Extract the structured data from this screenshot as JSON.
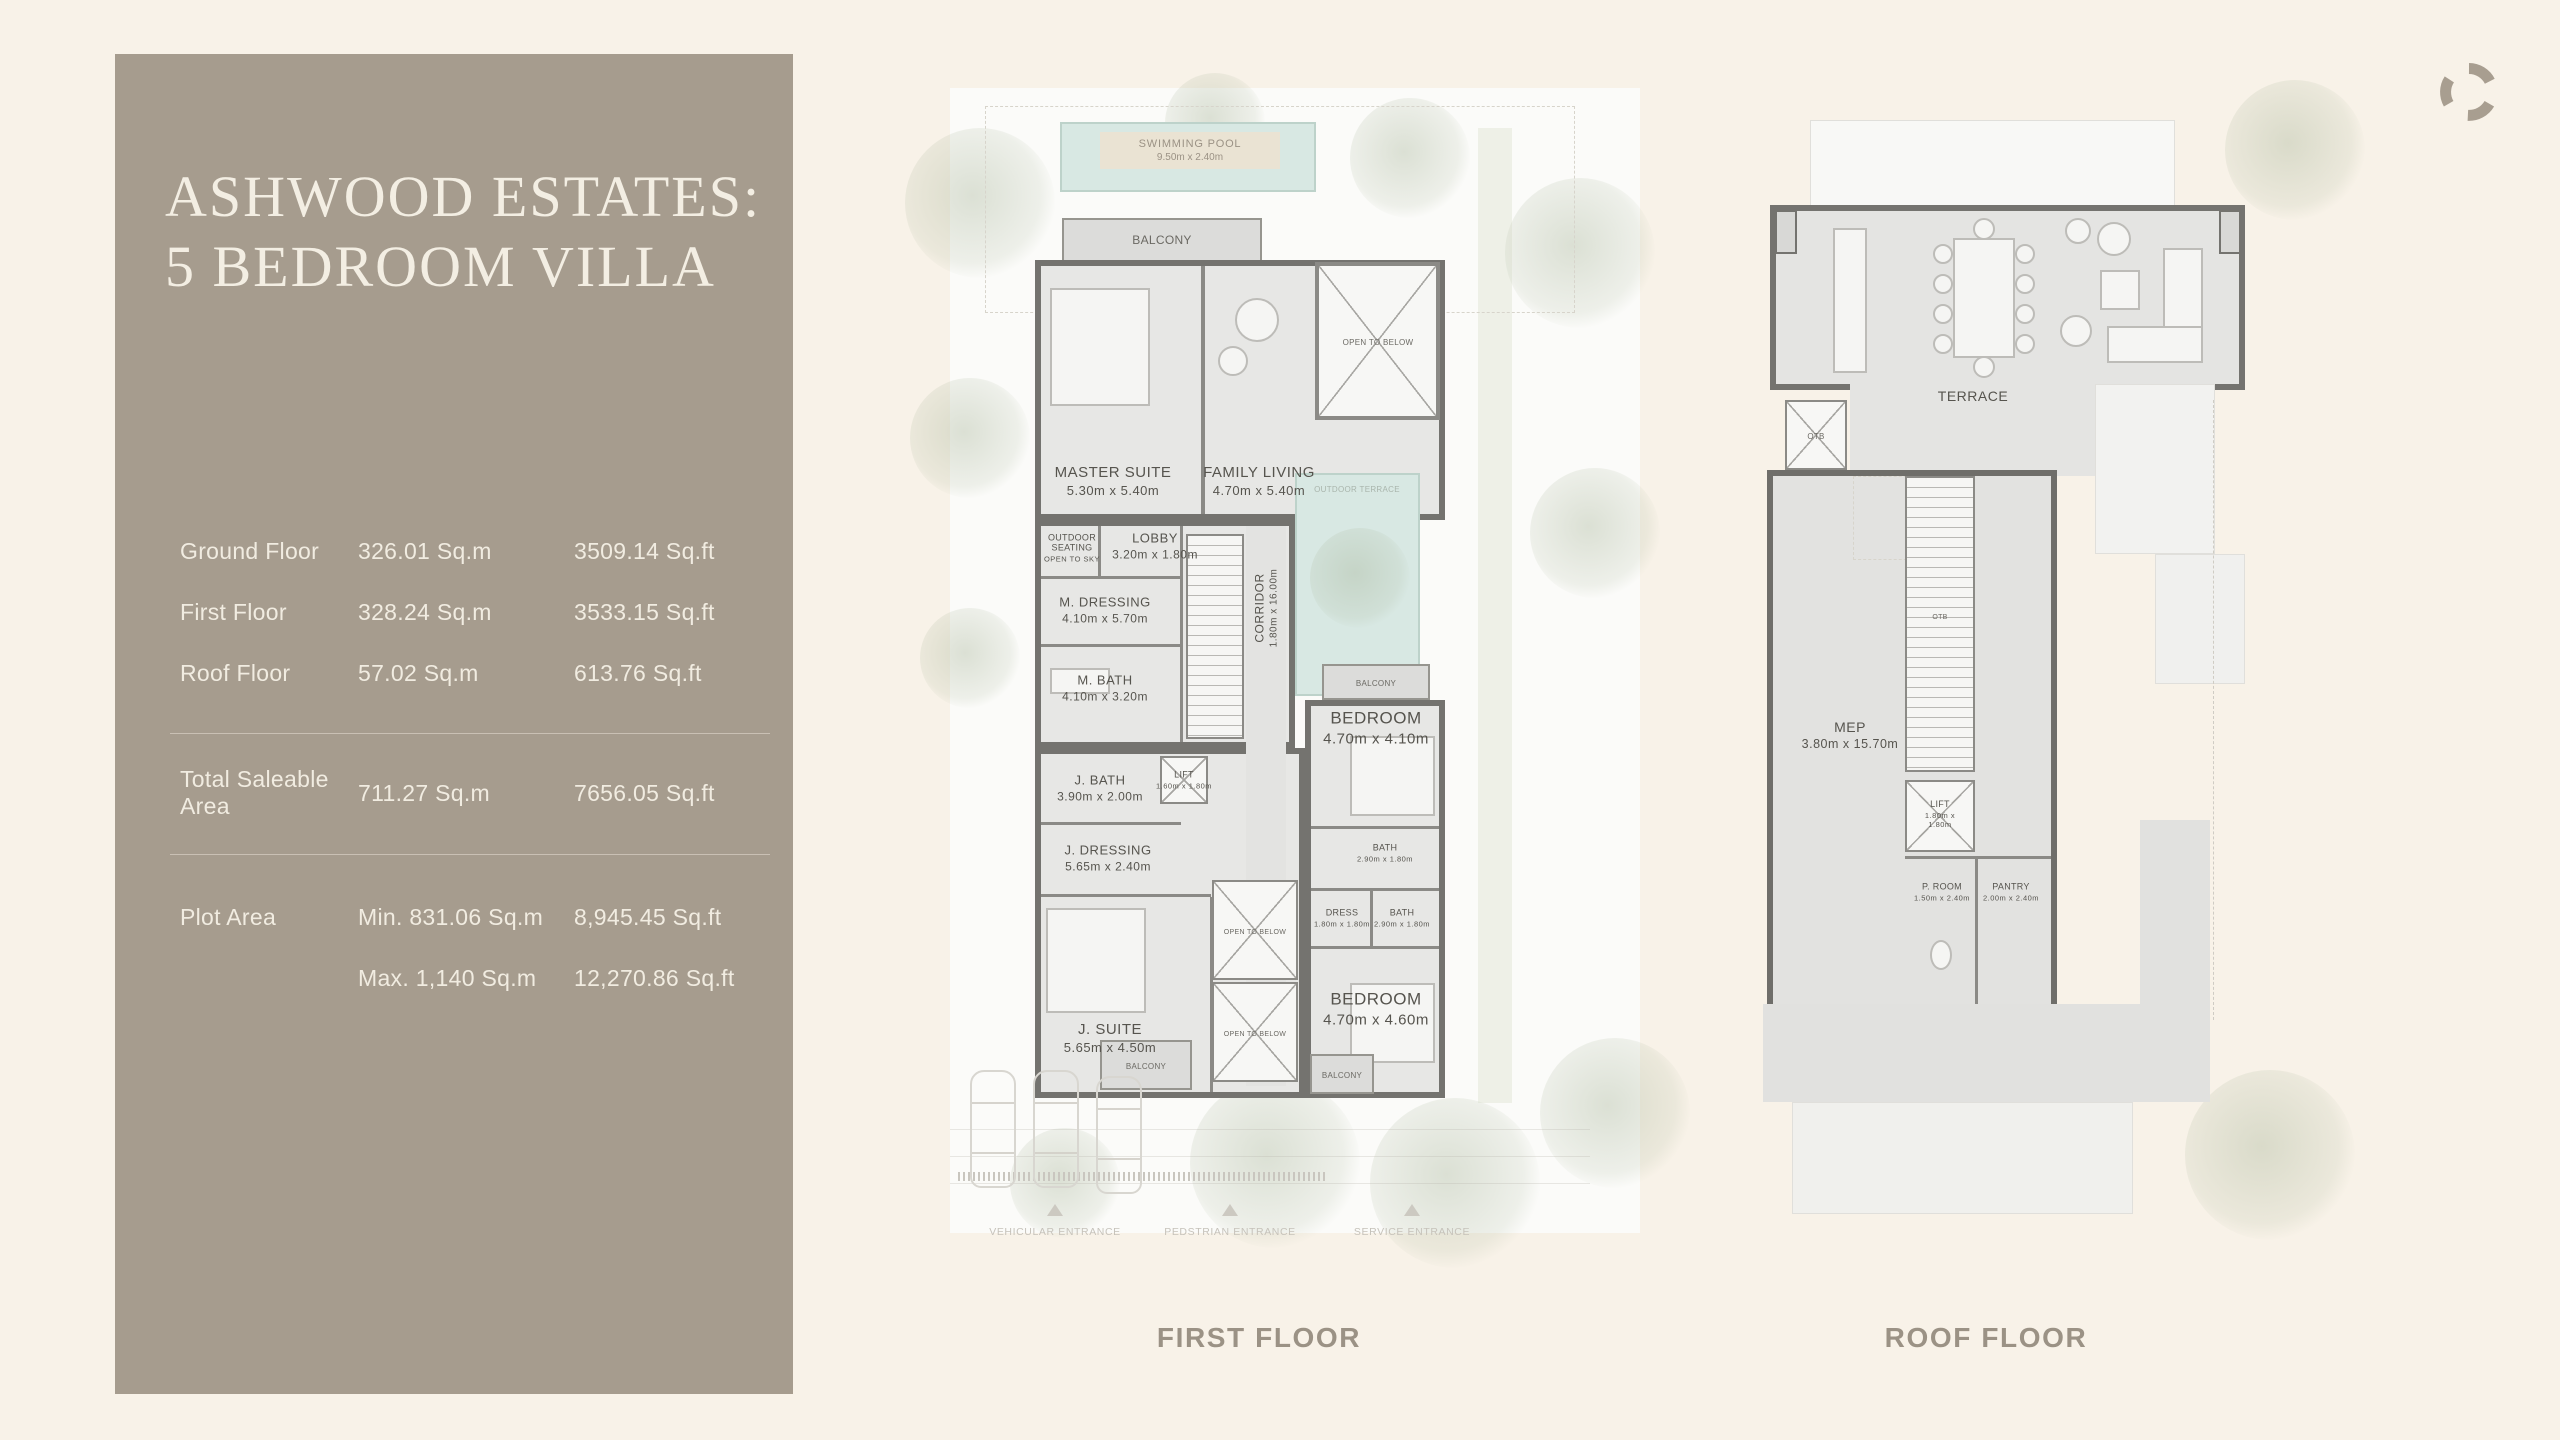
{
  "colors": {
    "page_background": "#f8f2e8",
    "sidebar_background": "#a69c8e",
    "sidebar_text": "#f1ece1",
    "plan_wall": "#74736f",
    "plan_room_fill": "#e7e7e5",
    "pool_fill": "#d8e8e3",
    "caption_text": "#9b9285"
  },
  "brand": {
    "logo_icon": "swirl-logo"
  },
  "sidebar": {
    "title_line1": "ASHWOOD ESTATES:",
    "title_line2": "5 BEDROOM VILLA",
    "floors": [
      {
        "label": "Ground Floor",
        "sqm": "326.01 Sq.m",
        "sqft": "3509.14 Sq.ft"
      },
      {
        "label": "First Floor",
        "sqm": "328.24 Sq.m",
        "sqft": "3533.15 Sq.ft"
      },
      {
        "label": "Roof Floor",
        "sqm": "57.02 Sq.m",
        "sqft": "613.76 Sq.ft"
      }
    ],
    "total": {
      "label": "Total Saleable Area",
      "sqm": "711.27 Sq.m",
      "sqft": "7656.05 Sq.ft"
    },
    "plot": {
      "label": "Plot Area",
      "min_sqm": "Min. 831.06 Sq.m",
      "min_sqft": "8,945.45 Sq.ft",
      "max_sqm": "Max. 1,140 Sq.m",
      "max_sqft": "12,270.86 Sq.ft"
    }
  },
  "plans": {
    "first": {
      "caption": "FIRST FLOOR",
      "rooms": {
        "pool": {
          "name": "SWIMMING POOL",
          "dims": "9.50m x 2.40m"
        },
        "balcony": {
          "name": "BALCONY"
        },
        "master_suite": {
          "name": "MASTER SUITE",
          "dims": "5.30m x 5.40m"
        },
        "family_living": {
          "name": "FAMILY LIVING",
          "dims": "4.70m x 5.40m"
        },
        "open_to_below": {
          "name": "OPEN TO BELOW"
        },
        "outdoor_seating": {
          "name": "OUTDOOR SEATING",
          "note": "OPEN TO SKY"
        },
        "lobby": {
          "name": "LOBBY",
          "dims": "3.20m x 1.80m"
        },
        "m_dressing": {
          "name": "M. DRESSING",
          "dims": "4.10m x 5.70m"
        },
        "m_bath": {
          "name": "M. BATH",
          "dims": "4.10m x 3.20m"
        },
        "corridor": {
          "name": "CORRIDOR",
          "dims": "1.80m x 16.00m"
        },
        "outdoor_terrace": {
          "name": "OUTDOOR TERRACE"
        },
        "j_bath": {
          "name": "J. BATH",
          "dims": "3.90m x 2.00m"
        },
        "lift": {
          "name": "LIFT",
          "dims": "1.60m x 1.80m"
        },
        "j_dressing": {
          "name": "J. DRESSING",
          "dims": "5.65m x 2.40m"
        },
        "j_suite": {
          "name": "J. SUITE",
          "dims": "5.65m x 4.50m"
        },
        "bedroom_top": {
          "name": "BEDROOM",
          "dims": "4.70m x 4.10m"
        },
        "bath_top": {
          "name": "BATH",
          "dims": "2.90m x 1.80m"
        },
        "dress": {
          "name": "DRESS",
          "dims": "1.80m x 1.80m"
        },
        "bath_bottom": {
          "name": "BATH",
          "dims": "2.90m x 1.80m"
        },
        "bedroom_bottom": {
          "name": "BEDROOM",
          "dims": "4.70m x 4.60m"
        }
      },
      "entrances": [
        {
          "label": "VEHICULAR ENTRANCE"
        },
        {
          "label": "PEDSTRIAN ENTRANCE"
        },
        {
          "label": "SERVICE ENTRANCE"
        }
      ]
    },
    "roof": {
      "caption": "ROOF FLOOR",
      "rooms": {
        "terrace": {
          "name": "TERRACE"
        },
        "otb": {
          "name": "OTB"
        },
        "mep": {
          "name": "MEP",
          "dims": "3.80m x 15.70m"
        },
        "lift": {
          "name": "LIFT",
          "dims": "1.80m x 1.80m"
        },
        "p_room": {
          "name": "P. ROOM",
          "dims": "1.50m x 2.40m"
        },
        "pantry": {
          "name": "PANTRY",
          "dims": "2.00m x 2.40m"
        }
      }
    }
  }
}
